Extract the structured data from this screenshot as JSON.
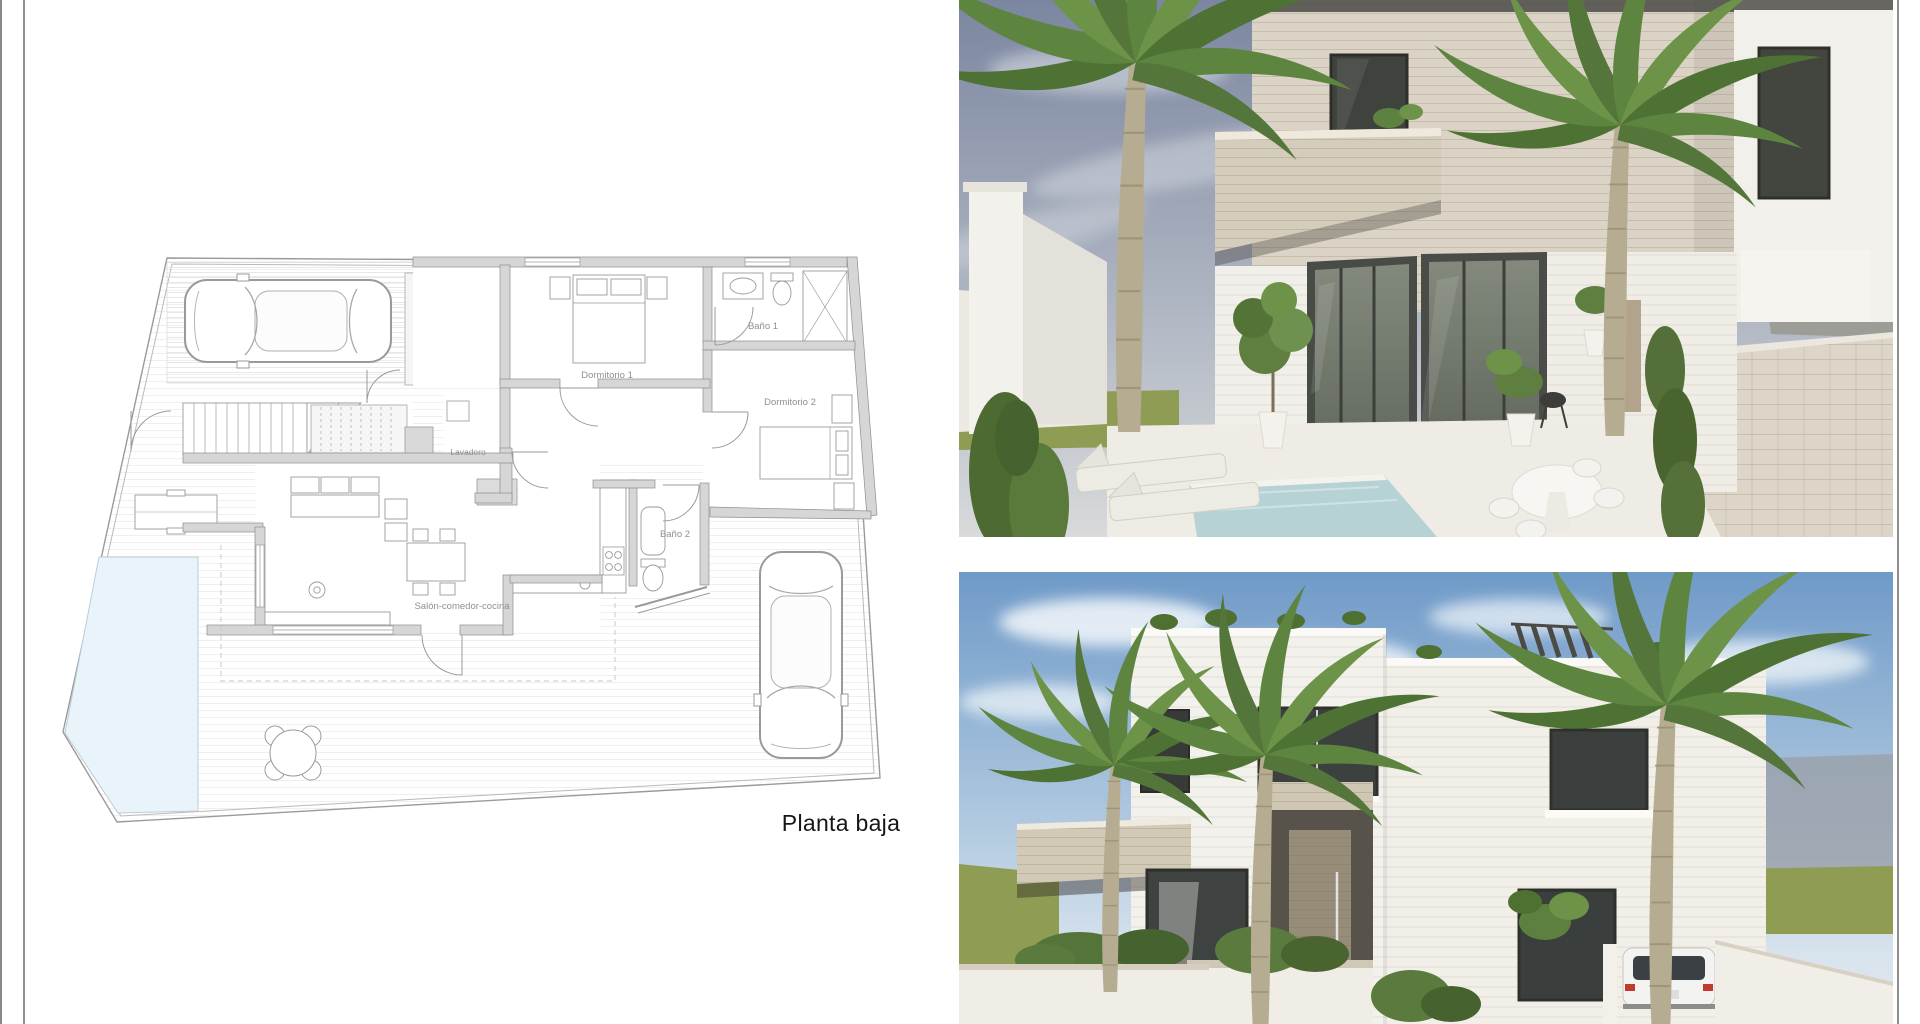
{
  "page": {
    "background": "#ffffff",
    "frame_line_color": "#8f8f8f"
  },
  "floor_plan": {
    "caption": "Planta baja",
    "rooms": [
      {
        "label": "Dormitorio 1"
      },
      {
        "label": "Baño 1"
      },
      {
        "label": "Dormitorio 2"
      },
      {
        "label": "Lavadero"
      },
      {
        "label": "Baño 2"
      },
      {
        "label": "Salón-comedor-cocina"
      }
    ],
    "colors": {
      "wall_fill": "#d6d6d6",
      "line": "#9a9a9a",
      "pool": "#e9f4fa",
      "label_text": "#8f8f8f",
      "caption_text": "#161616"
    }
  },
  "renders": {
    "top": {
      "name": "exterior-view-terrace-pool",
      "colors": {
        "sky_top": "#7b86a0",
        "sky_horizon": "#d8dadb",
        "grass": "#8e9d53",
        "stone": "#dbd4c6",
        "white_wall": "#f2f0ea",
        "glass": "#4a4d47",
        "pool": "#b7d2d5",
        "paving": "#dcd5c8",
        "palm": "#5d8540"
      }
    },
    "bottom": {
      "name": "exterior-view-front-facade",
      "colors": {
        "sky_top": "#6f9ac8",
        "sky_horizon": "#e4e8ea",
        "grass": "#8e9d53",
        "white_wall": "#f3f1ec",
        "stone_trim": "#d2c9b7",
        "door_stone": "#968c78",
        "glass": "#3b403f",
        "palm": "#5d8540"
      }
    }
  }
}
